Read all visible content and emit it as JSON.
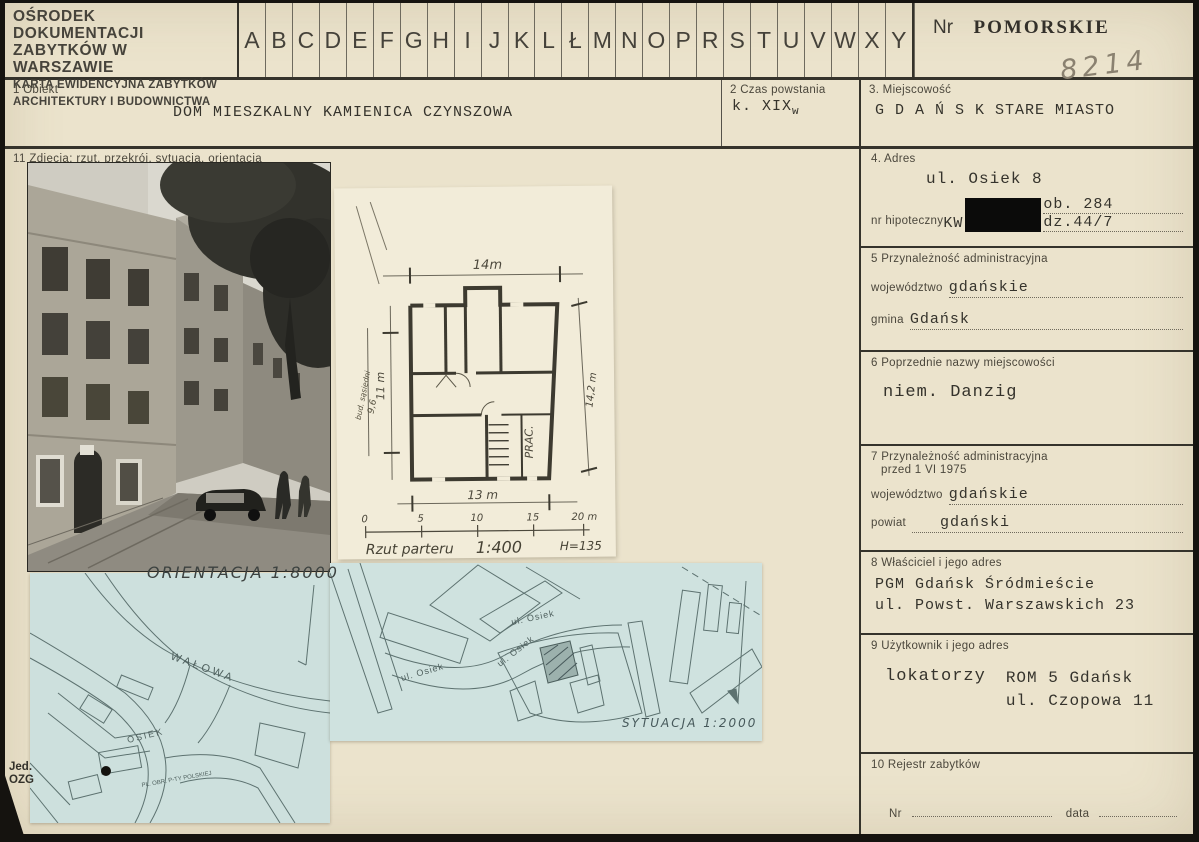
{
  "header": {
    "org_line1": "OŚRODEK DOKUMENTACJI",
    "org_line2": "ZABYTKÓW W WARSZAWIE",
    "org_line3": "KARTA EWIDENCYJNA ZABYTKÓW",
    "org_line4": "ARCHITEKTURY I BUDOWNICTWA",
    "alphabet": [
      "A",
      "B",
      "C",
      "D",
      "E",
      "F",
      "G",
      "H",
      "I",
      "J",
      "K",
      "L",
      "Ł",
      "M",
      "N",
      "O",
      "P",
      "R",
      "S",
      "T",
      "U",
      "V",
      "W",
      "X",
      "Y",
      "Z"
    ],
    "nr_label": "Nr",
    "region": "POMORSKIE",
    "card_number": "8214"
  },
  "row2": {
    "f1_label": "1  Obiekt",
    "f1_value": "DOM MIESZKALNY   KAMIENICA CZYNSZOWA",
    "f2_label": "2  Czas powstania",
    "f2_value": "k. XIX",
    "f2_value_sub": "w",
    "f3_label": "3. Miejscowość",
    "f3_value": "G D A Ń S K   STARE MIASTO"
  },
  "photos": {
    "f11_label": "11  Zdjęcia:  rzut, przekrój, sytuacja, orientacja"
  },
  "plan": {
    "dim_top": "14m",
    "dim_left": "11 m",
    "side_building": "bud. sąsiedni",
    "side_dim": "9,6",
    "room_label": "PRAC.",
    "dim_right": "14,2 m",
    "dim_bottom": "13 m",
    "scale_ticks": [
      "0",
      "5",
      "10",
      "15",
      "20 m"
    ],
    "caption": "Rzut parteru",
    "caption_scale": "1:400",
    "caption_h": "H=135"
  },
  "orientation_map": {
    "caption": "ORIENTACJA 1:8000",
    "street_walowa": "WAŁOWA",
    "street_osiek": "OSIEK",
    "street_poczty": "PL. OBR. P-TY POLSKIEJ"
  },
  "situation_map": {
    "caption": "SYTUACJA 1:2000",
    "streets": [
      "ul. Osiek",
      "ul. Osiek",
      "ul. Osiek"
    ]
  },
  "corner_note": {
    "line1": "Jed.",
    "line2": "OZG"
  },
  "right": {
    "f4": {
      "label": "4.  Adres",
      "address": "ul. Osiek 8",
      "hip_label": "nr hipoteczny",
      "kw": "KW",
      "ob": "ob.  284",
      "dz": "dz.44/7"
    },
    "f5": {
      "label": "5  Przynależność administracyjna",
      "woj_label": "województwo",
      "woj": "gdańskie",
      "gmina_label": "gmina",
      "gmina": "Gdańsk"
    },
    "f6": {
      "label": "6  Poprzednie nazwy miejscowości",
      "value": "niem. Danzig"
    },
    "f7": {
      "label_line1": "7  Przynależność administracyjna",
      "label_line2": "przed 1 VI 1975",
      "woj_label": "województwo",
      "woj": "gdańskie",
      "powiat_label": "powiat",
      "powiat": "gdański"
    },
    "f8": {
      "label": "8  Właściciel i jego adres",
      "line1": "PGM Gdańsk Śródmieście",
      "line2": "ul. Powst. Warszawskich 23"
    },
    "f9": {
      "label": "9  Użytkownik i jego adres",
      "col1": "lokatorzy",
      "line1": "ROM 5 Gdańsk",
      "line2": "ul. Czopowa 11"
    },
    "f10": {
      "label": "10  Rejestr zabytków",
      "nr_label": "Nr",
      "data_label": "data"
    }
  }
}
